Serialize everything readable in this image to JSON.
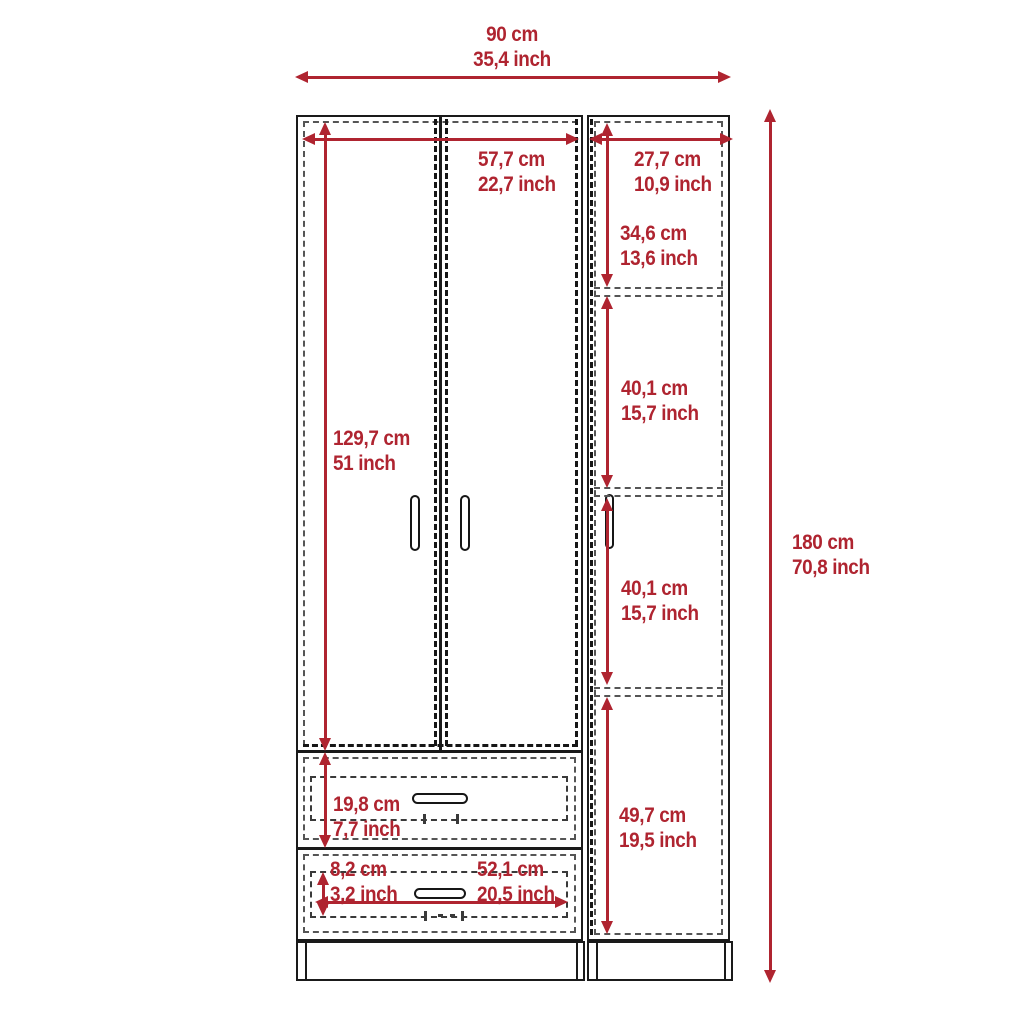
{
  "colors": {
    "dimension_red": "#AF2430",
    "outline_black": "#1a1a1a"
  },
  "dimensions": {
    "overall_width": {
      "cm": "90 cm",
      "inch": "35,4 inch"
    },
    "overall_height": {
      "cm": "180 cm",
      "inch": "70,8 inch"
    },
    "door_section_width": {
      "cm": "57,7 cm",
      "inch": "22,7 inch"
    },
    "side_section_width": {
      "cm": "27,7 cm",
      "inch": "10,9 inch"
    },
    "door_height": {
      "cm": "129,7 cm",
      "inch": "51 inch"
    },
    "top_compartment_height": {
      "cm": "34,6 cm",
      "inch": "13,6 inch"
    },
    "upper_middle_compartment_height": {
      "cm": "40,1 cm",
      "inch": "15,7 inch"
    },
    "lower_middle_compartment_height": {
      "cm": "40,1 cm",
      "inch": "15,7 inch"
    },
    "bottom_compartment_height": {
      "cm": "49,7 cm",
      "inch": "19,5 inch"
    },
    "drawer_height": {
      "cm": "19,8 cm",
      "inch": "7,7 inch"
    },
    "drawer_front_height": {
      "cm": "8,2 cm",
      "inch": "3,2 inch"
    },
    "drawer_width": {
      "cm": "52,1 cm",
      "inch": "20,5 inch"
    }
  }
}
